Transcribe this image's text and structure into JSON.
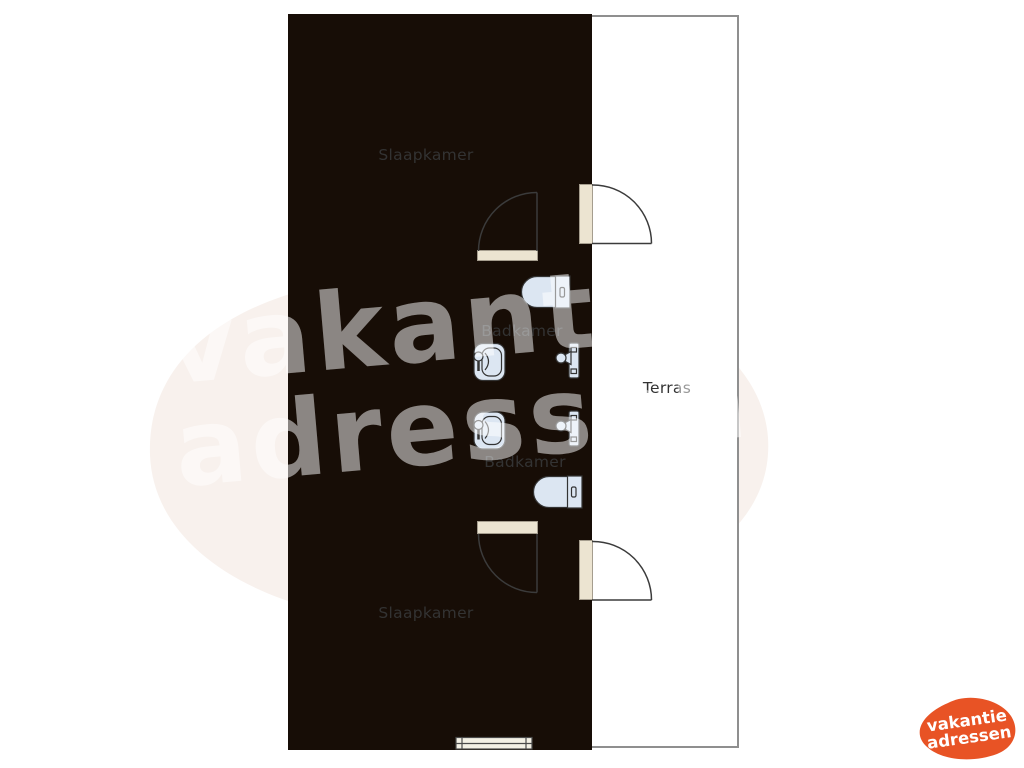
{
  "floorplan": {
    "rooms": [
      {
        "id": "slaapkamer-1",
        "label": "Slaapkamer",
        "type": "bedroom"
      },
      {
        "id": "slaapkamer-2",
        "label": "Slaapkamer",
        "type": "bedroom"
      },
      {
        "id": "badkamer-1",
        "label": "Badkamer",
        "type": "bathroom"
      },
      {
        "id": "badkamer-2",
        "label": "Badkamer",
        "type": "bathroom"
      },
      {
        "id": "terras",
        "label": "Terras",
        "type": "terrace"
      }
    ],
    "colors": {
      "bedroom_fill": "#f6bd69",
      "bathroom_fill": "#ccdaeb",
      "wall": "#170d06",
      "terrace_outline": "#8f8f8f",
      "door_opening": "#ece4d1"
    }
  },
  "watermark": {
    "line1": "vakantie",
    "line2": "adressen"
  },
  "logo": {
    "line1": "vakantie",
    "line2": "adressen",
    "blob_color": "#e85325",
    "text_color": "#ffffff"
  }
}
